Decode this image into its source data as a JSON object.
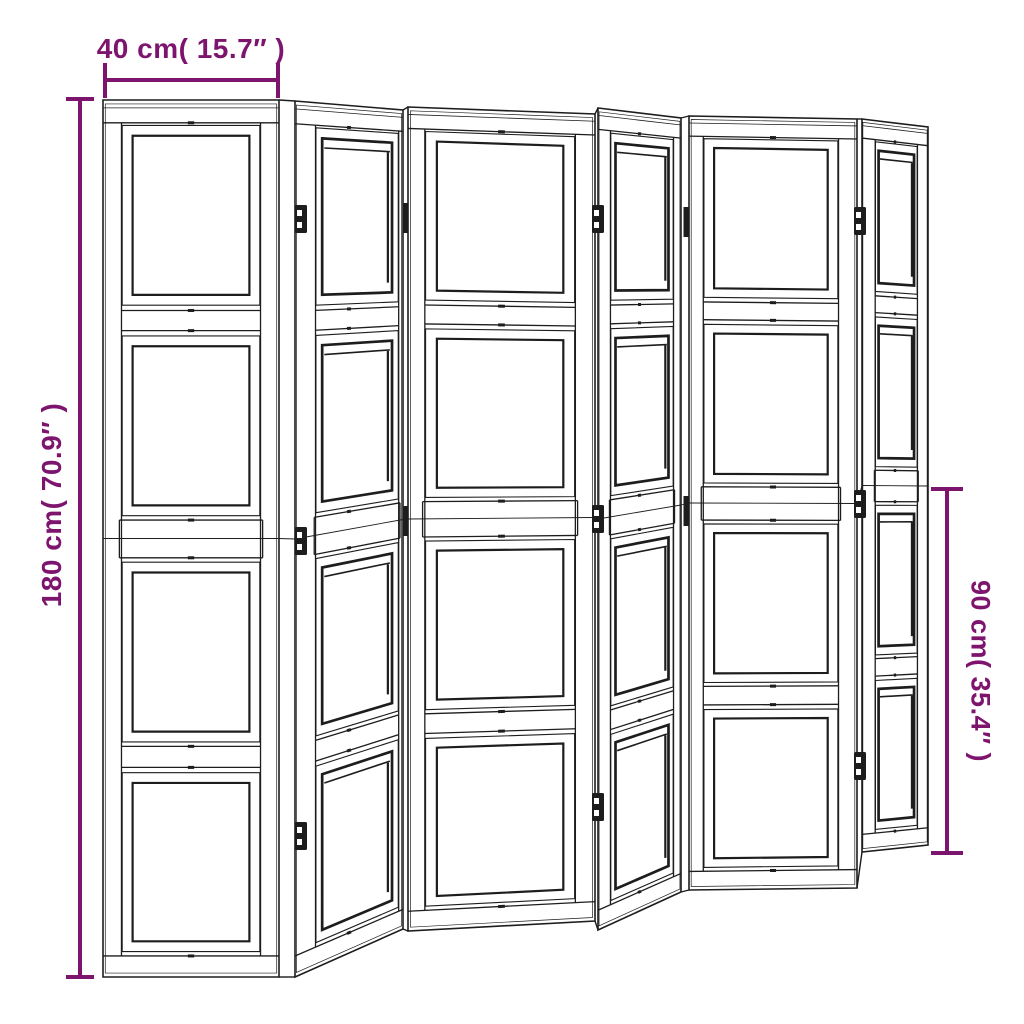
{
  "diagram": {
    "subject": "folding room divider screen",
    "panel_count": 6,
    "sections_per_panel": 4,
    "hinge_joint_count": 5
  },
  "dimensions": {
    "width": {
      "label": "40 cm( 15.7″ )",
      "orientation": "horizontal-top"
    },
    "height": {
      "label": "180 cm( 70.9″ )",
      "orientation": "vertical-left"
    },
    "half_height": {
      "label": "90 cm( 35.4″ )",
      "orientation": "vertical-right"
    }
  },
  "colors": {
    "dimension": "#7D156E",
    "line": "#1d1d1d",
    "background": "#ffffff"
  },
  "icons": {
    "hinge": "hinge-icon",
    "hinge_pin": "hinge-pin-icon"
  }
}
